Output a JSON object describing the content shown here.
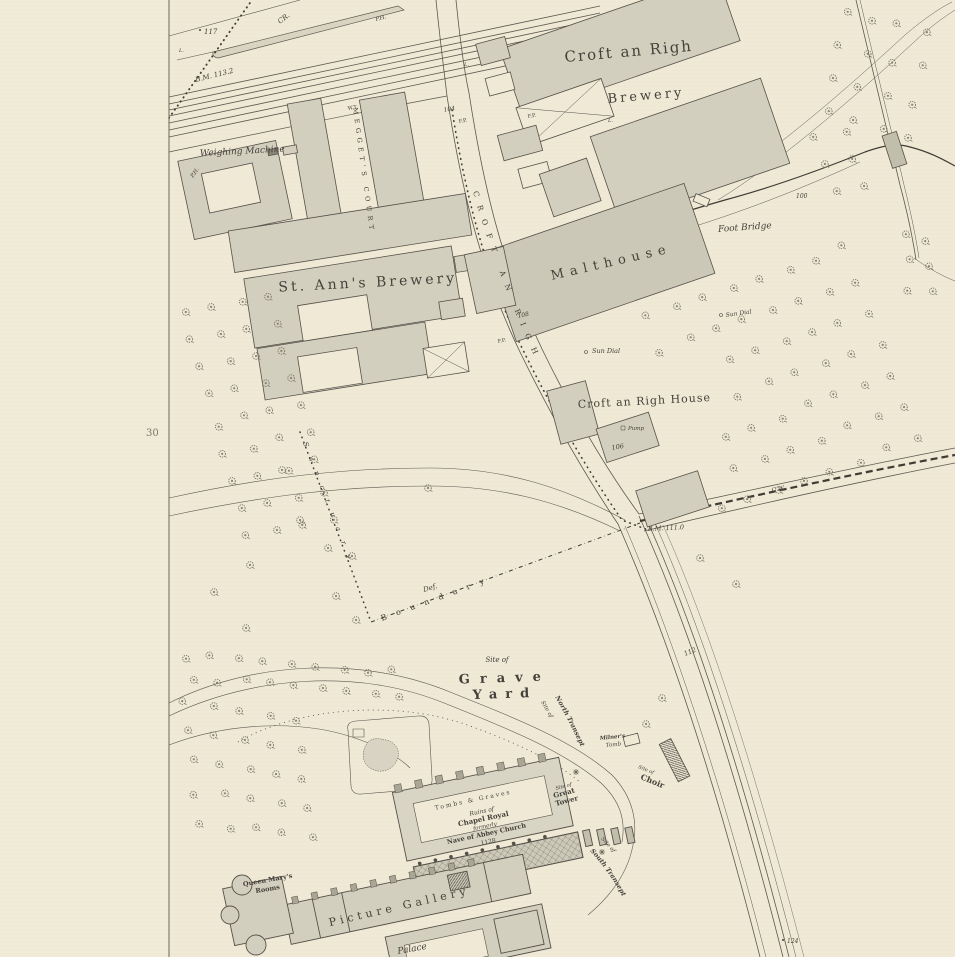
{
  "colors": {
    "paper": "#efe9d6",
    "ink": "#45413a",
    "building": "#d3cfbe",
    "building_dark": "#c2beac",
    "line_faint": "#8b8779"
  },
  "sheet": {
    "margin_number": "30"
  },
  "streets": {
    "croft_an_righ": "CROFT AN RIGH"
  },
  "places": {
    "croft_brewery_name": "Croft an Righ",
    "croft_brewery_word": "Brewery",
    "st_anns": "St. Ann's Brewery",
    "meggets_court": "MEGGET'S COURT",
    "malthouse": "Malthouse",
    "weighing_machine": "Weighing Machine",
    "foot_bridge": "Foot Bridge",
    "croft_house": "Croft an Righ House",
    "pump": "Pump",
    "sun_dial_1": "Sun Dial",
    "sun_dial_2": "Sun Dial"
  },
  "boundaries": {
    "sanctuary": "Sanctuary",
    "boundary": "Boundary",
    "def": "Def.",
    "cw": "C.W.",
    "cr": "CR."
  },
  "benchmarks": {
    "bm_north": "B.M. 113.2",
    "bm_south": "B.M. 111.0"
  },
  "spot_heights": {
    "h117": "117",
    "h100": "100",
    "h104": "104",
    "h108": "108",
    "h106": "106",
    "h112": "112",
    "h124": "124"
  },
  "small_labels": {
    "ph_west": "P.H.",
    "ph_north": "P.H.",
    "fp_1": "F.P.",
    "fp_2": "F.P.",
    "fp_3": "F.P.",
    "wt": "W.T.",
    "lamp_1": "L.",
    "lamp_2": "L.",
    "lamp_3": "L."
  },
  "abbey": {
    "graveyard_site_of": "Site of",
    "grave": "Grave",
    "yard": "Yard",
    "site_of_nt": "Site of",
    "north_transept": "North Transept",
    "milners": "Milner's",
    "tomb": "Tomb",
    "site_of_choir": "Site of",
    "choir": "Choir",
    "site_of_tower": "Site of",
    "great": "Great",
    "tower": "Tower",
    "tombs_graves": "Tombs & Graves",
    "ruins_line1": "Ruins of",
    "ruins_line2": "Chapel Royal",
    "ruins_line3": "formerly",
    "ruins_line4": "Nave of Abbey Church",
    "ruins_line5": "1128",
    "site_of_st": "Site of",
    "south_transept": "South Transept"
  },
  "palace": {
    "queen_marys": "Queen Mary's",
    "rooms": "Rooms",
    "picture_gallery": "Picture Gallery",
    "palace_fragment": "Palace"
  },
  "tree_clusters": [
    {
      "name": "orchard-east",
      "x": 648,
      "y": 318,
      "ux": 28,
      "uy": -10,
      "vx": 12,
      "vy": 32,
      "cols": 8,
      "rows": 7,
      "exclude": {
        "x0": 596,
        "y0": 356,
        "x1": 714,
        "y1": 545
      }
    },
    {
      "name": "orchard-west",
      "x": 184,
      "y": 312,
      "ux": 28,
      "uy": -6,
      "vx": 8,
      "vy": 28,
      "cols": 4,
      "rows": 9
    },
    {
      "name": "avenue-row",
      "x": 186,
      "y": 656,
      "ux": 26,
      "uy": 2,
      "vx": 6,
      "vy": 22,
      "cols": 9,
      "rows": 2
    },
    {
      "name": "graveyard-west",
      "x": 184,
      "y": 702,
      "ux": 28,
      "uy": 4,
      "vx": 4,
      "vy": 30,
      "cols": 5,
      "rows": 5
    },
    {
      "name": "top-right",
      "x": 845,
      "y": 10,
      "ux": 27,
      "uy": 8,
      "vx": -6,
      "vy": 34,
      "cols": 4,
      "rows": 4
    },
    {
      "name": "wall-east",
      "x": 905,
      "y": 236,
      "ux": 22,
      "uy": 6,
      "vx": 2,
      "vy": 26,
      "cols": 2,
      "rows": 3
    },
    {
      "name": "stream-north",
      "x": 814,
      "y": 136,
      "ux": 30,
      "uy": -6,
      "vx": 10,
      "vy": 28,
      "cols": 2,
      "rows": 3
    }
  ],
  "extra_trees": [
    [
      662,
      698
    ],
    [
      646,
      724
    ],
    [
      736,
      584
    ],
    [
      700,
      558
    ],
    [
      300,
      520
    ],
    [
      328,
      548
    ],
    [
      336,
      596
    ],
    [
      356,
      620
    ],
    [
      428,
      488
    ],
    [
      352,
      556
    ],
    [
      282,
      470
    ],
    [
      250,
      565
    ],
    [
      214,
      592
    ],
    [
      246,
      628
    ]
  ],
  "shrubs": [
    [
      576,
      772
    ],
    [
      602,
      852
    ]
  ]
}
